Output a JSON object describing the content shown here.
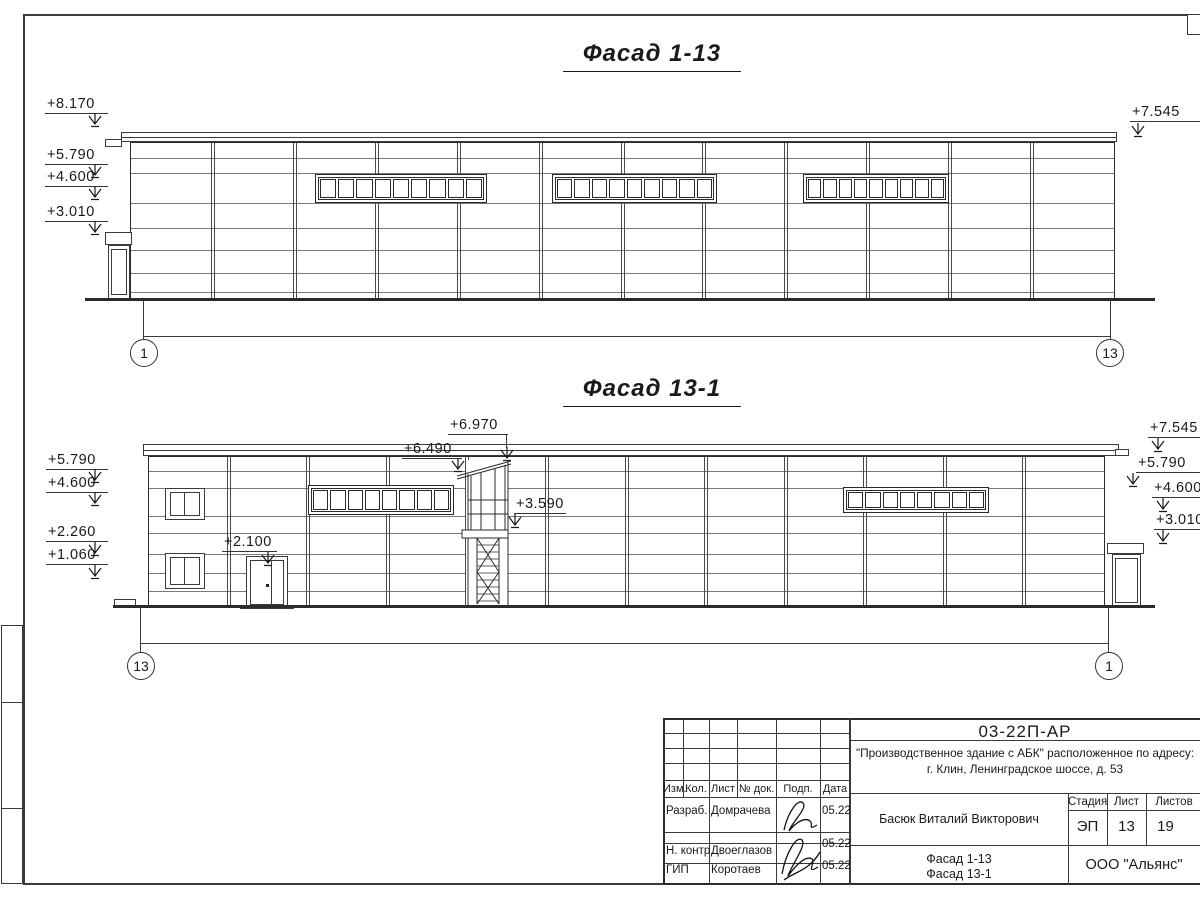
{
  "drawing1": {
    "title": "Фасад 1-13",
    "grid_left": "1",
    "grid_right": "13",
    "marks_left": [
      "+8.170",
      "+5.790",
      "+4.600",
      "+3.010"
    ],
    "marks_right": [
      "+7.545"
    ],
    "bays": 12,
    "band_panes": 9
  },
  "drawing2": {
    "title": "Фасад 13-1",
    "grid_left": "13",
    "grid_right": "1",
    "marks_left": [
      "+5.790",
      "+4.600",
      "+2.260",
      "+1.060"
    ],
    "marks_right": [
      "+7.545",
      "+5.790",
      "+4.600",
      "+3.010"
    ],
    "marks_center": [
      "+6.970",
      "+6.490",
      "+3.590",
      "+2.100"
    ],
    "bays": 12,
    "band_panes": 8
  },
  "title_block": {
    "doc_number": "03-22П-АР",
    "project_name_line1": "\"Производственное здание с АБК\" расположенное по адресу:",
    "project_name_line2": "г. Клин, Ленинградское шоссе, д. 53",
    "header_columns": [
      "Изм.",
      "Кол.",
      "Лист",
      "№ док.",
      "Подп.",
      "Дата"
    ],
    "signers": [
      {
        "role": "Разраб.",
        "name": "Домрачева",
        "date": "05.22"
      },
      {
        "role": "Н. контр.",
        "name": "Двоеглазов",
        "date": "05.22"
      },
      {
        "role": "ГИП",
        "name": "Коротаев",
        "date": "05.22"
      }
    ],
    "author": "Басюк Виталий Викторович",
    "stage_label": "Стадия",
    "stage_value": "ЭП",
    "sheet_label": "Лист",
    "sheet_value": "13",
    "sheets_label": "Листов",
    "sheets_value": "19",
    "content_line1": "Фасад 1-13",
    "content_line2": "Фасад 13-1",
    "company": "ООО \"Альянс\""
  },
  "colors": {
    "line": "#1a1a1a",
    "background": "#ffffff"
  }
}
